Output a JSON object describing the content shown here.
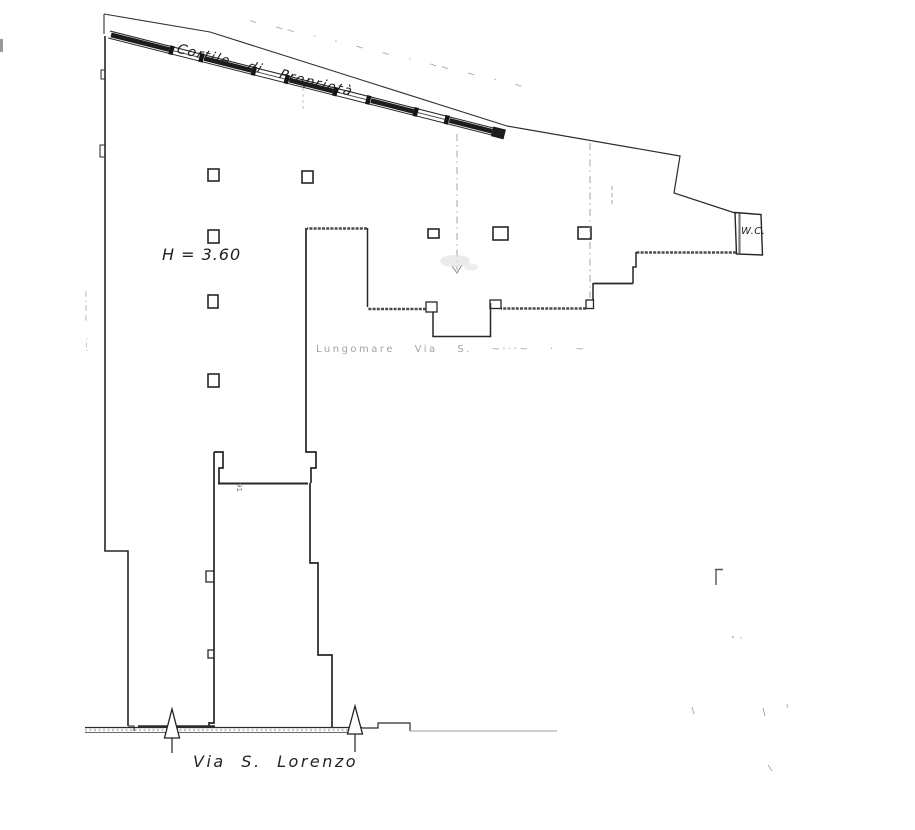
{
  "floor_plan": {
    "annotations": {
      "courtyard_faint": "~ ~~ ·  · ~ ~ ·  ~~ ~ · ~",
      "courtyard": "Cortile di Proprietà",
      "height_note": "H = 3.60",
      "wc": "W.C.",
      "street_faint": "Lungomare  Via S. ~···~ · ~",
      "street": "Via S. Lorenzo",
      "tiny_note": "91",
      "margin_note_a": "~·~~",
      "margin_note_b": "·~·"
    },
    "colors": {
      "ink": "#262626",
      "wall_fill": "#1c1c1c",
      "hatch": "#4a4a4a",
      "faint": "#9b9b9b",
      "paper": "#ffffff"
    }
  }
}
